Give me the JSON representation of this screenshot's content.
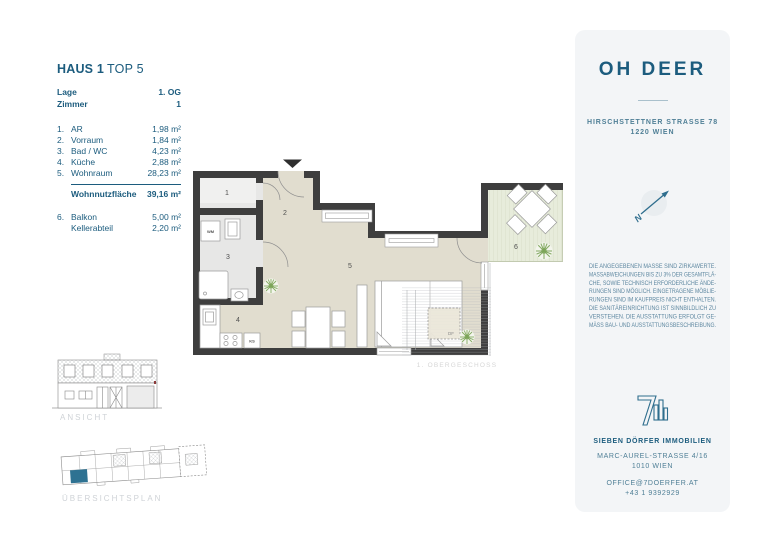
{
  "info": {
    "title_primary": "HAUS 1",
    "title_secondary": "TOP 5",
    "meta": [
      {
        "label": "Lage",
        "value": "1. OG"
      },
      {
        "label": "Zimmer",
        "value": "1"
      }
    ],
    "rooms": [
      {
        "num": "1.",
        "name": "AR",
        "value": "1,98 m²"
      },
      {
        "num": "2.",
        "name": "Vorraum",
        "value": "1,84 m²"
      },
      {
        "num": "3.",
        "name": "Bad / WC",
        "value": "4,23 m²"
      },
      {
        "num": "4.",
        "name": "Küche",
        "value": "2,88 m²"
      },
      {
        "num": "5.",
        "name": "Wohnraum",
        "value": "28,23 m²"
      }
    ],
    "total": {
      "label": "Wohnnutzfläche",
      "value": "39,16 m²"
    },
    "extras": [
      {
        "num": "6.",
        "name": "Balkon",
        "value": "5,00 m²"
      },
      {
        "num": "",
        "name": "Kellerabteil",
        "value": "2,20 m²"
      }
    ]
  },
  "plan": {
    "room_labels": [
      "1",
      "2",
      "3",
      "4",
      "5",
      "6"
    ],
    "wm": "WM",
    "ks": "KS",
    "df": "DF",
    "caption": "1. OBERGESCHOSS"
  },
  "drawings": {
    "elevation_caption": "ANSICHT",
    "siteplan_caption": "ÜBERSICHTSPLAN"
  },
  "brand_panel": {
    "name": "OH DEER",
    "address1": "HIRSCHSTETTNER STRASSE 78",
    "address2": "1220 WIEN",
    "compass": "N",
    "disclaimer": [
      "DIE ANGEGEBENEN MASSE SIND ZIRKAWERTE.",
      "MASSABWEICHUNGEN BIS ZU 3% DER GESAMTFLÄ-",
      "CHE, SOWIE TECHNISCH ERFORDERLICHE ÄNDE-",
      "RUNGEN SIND MÖGLICH. EINGETRAGENE MÖBLIE-",
      "RUNGEN SIND IM KAUFPREIS NICHT ENTHALTEN.",
      "DIE SANITÄREINRICHTUNG IST SINNBILDLICH ZU",
      "VERSTEHEN. DIE AUSSTATTUNG ERFOLGT GE-",
      "MÄSS BAU- UND AUSSTATTUNGSBESCHREIBUNG."
    ],
    "company": "SIEBEN DÖRFER IMMOBILIEN",
    "company_address1": "MARC-AUREL-STRASSE 4/16",
    "company_address2": "1010 WIEN",
    "email": "OFFICE@7DOERFER.AT",
    "phone": "+43 1 9392929"
  },
  "colors": {
    "brand_blue": "#1c5c7e",
    "muted_blue": "#4f7f96",
    "wall_dark": "#3e3e3e",
    "floor_beige": "#e1ddcf",
    "floor_gray": "#e7e7e6",
    "balcony_green": "#e7ecdb",
    "plant_green": "#7aa356",
    "siteplan_highlight": "#2e7292",
    "caption_gray": "#cfd3d7"
  }
}
